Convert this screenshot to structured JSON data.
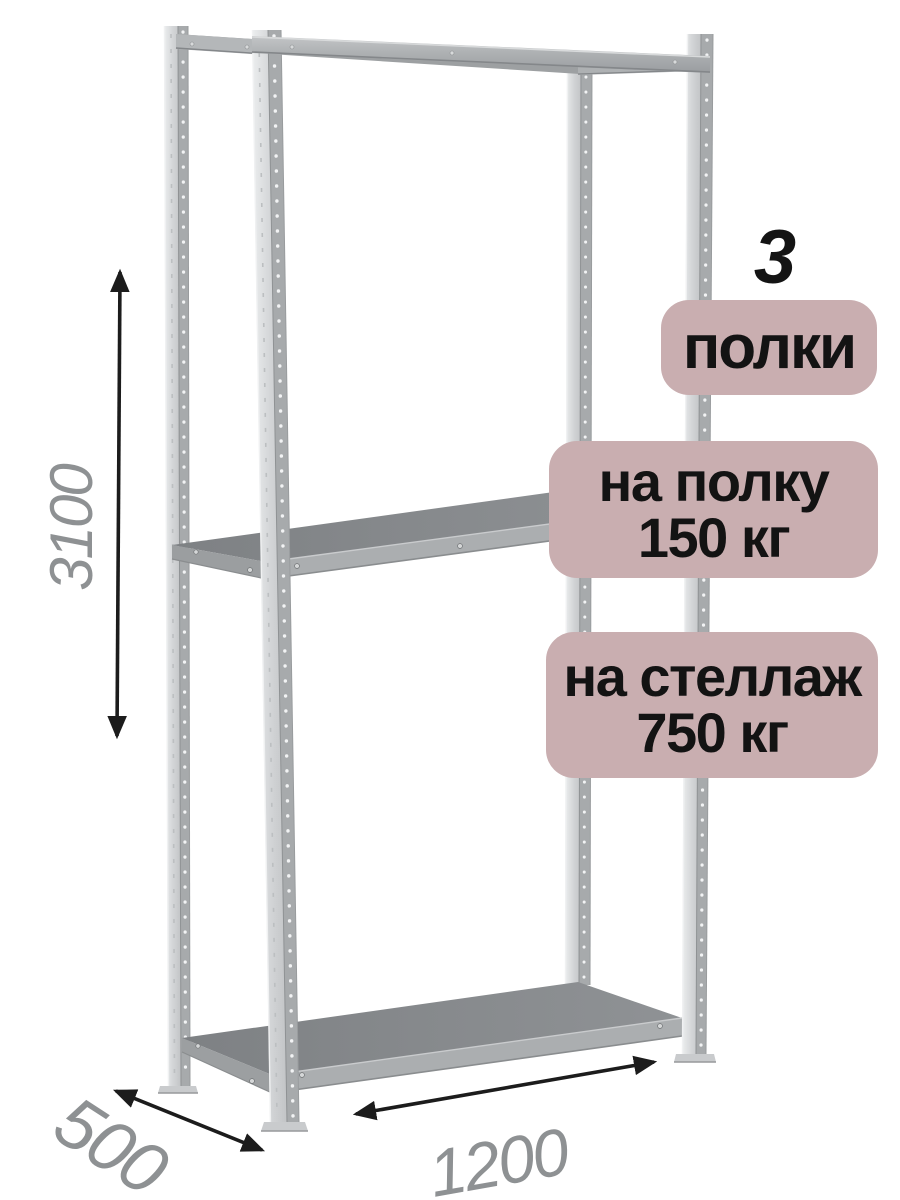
{
  "page": {
    "background": "#ffffff",
    "description": "isometric render of a grey metal boltless shelving rack with 3 shelves and dimension arrows"
  },
  "annotations": {
    "shelf_count_value": "3",
    "shelf_count_unit": "полки",
    "per_shelf_line1": "на полку",
    "per_shelf_line2": "150 кг",
    "per_rack_line1": "на стеллаж",
    "per_rack_line2": "750 кг",
    "badge_bg": "#c9aeb0",
    "badge_text_color": "#131313"
  },
  "dimensions": {
    "height_mm": "3100",
    "depth_mm": "500",
    "width_mm": "1200",
    "label_color": "#8e9193",
    "arrow_color": "#1c1c1c"
  },
  "rack_colors": {
    "post_light": "#dfe1e2",
    "post_stripe": "#a7aaac",
    "perforation": "#f2f3f4",
    "beam_face": "#b0b3b5",
    "shelf_top": "#84878a",
    "shelf_lip": "#abaeb0"
  }
}
